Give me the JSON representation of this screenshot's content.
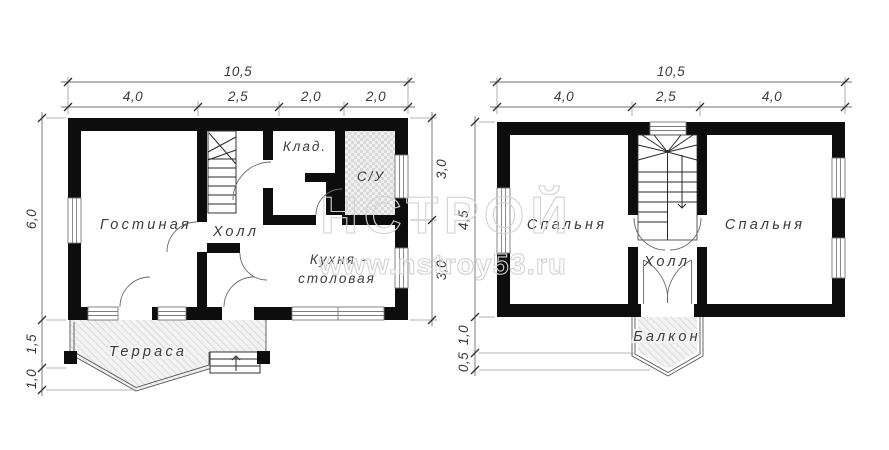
{
  "watermark": {
    "brand": "НСТРОЙ",
    "url": "www.nstroy53.ru"
  },
  "floor1": {
    "rooms": {
      "living": "Гостиная",
      "hall": "Холл",
      "storage": "Клад.",
      "bathroom": "С/У",
      "kitchen_line1": "Кухня -",
      "kitchen_line2": "столовая",
      "terrace": "Терраса"
    },
    "dims": {
      "total_width": "10,5",
      "top_segments": [
        "4,0",
        "2,5",
        "2,0",
        "2,0"
      ],
      "left_height": "6,0",
      "terrace_depth": "1,5",
      "terrace_point": "1,0",
      "right_upper": "3,0",
      "right_lower": "3,0"
    }
  },
  "floor2": {
    "rooms": {
      "bedroom_left": "Спальня",
      "bedroom_right": "Спальня",
      "hall": "Холл",
      "balcony": "Балкон"
    },
    "dims": {
      "total_width": "10,5",
      "top_segments": [
        "4,0",
        "2,5",
        "4,0"
      ],
      "left_height": "4,5",
      "balcony_depth": "1,0",
      "balcony_point": "0,5"
    }
  }
}
